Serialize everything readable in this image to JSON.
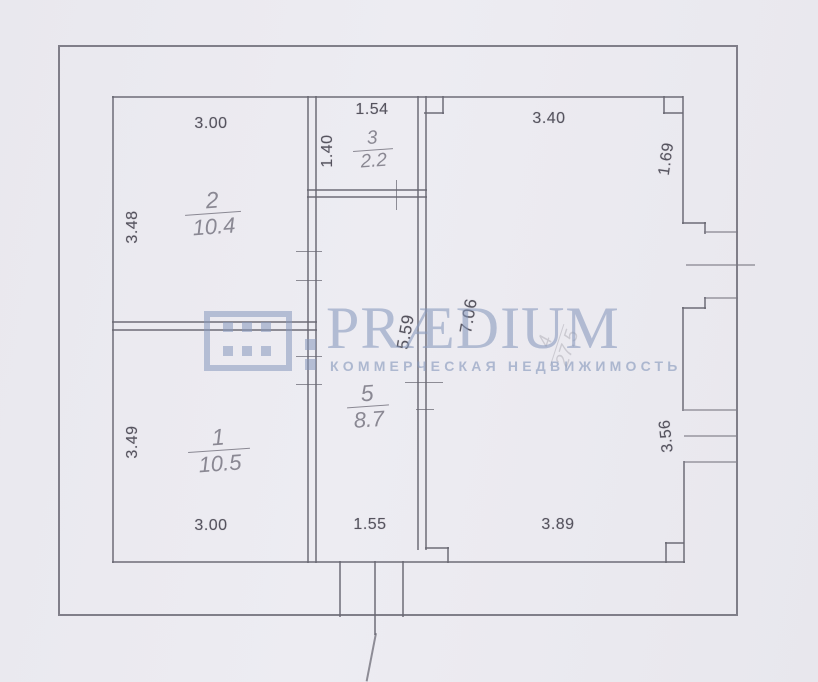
{
  "watermark": {
    "brand": "PRÆDIUM",
    "tagline": "КОММЕРЧЕСКАЯ НЕДВИЖИМОСТЬ",
    "color": "#8698bb"
  },
  "plan": {
    "rooms": [
      {
        "number": "1",
        "area": "10.5"
      },
      {
        "number": "2",
        "area": "10.4"
      },
      {
        "number": "3",
        "area": "2.2"
      },
      {
        "number": "4",
        "area": "27.5"
      },
      {
        "number": "5",
        "area": "8.7"
      }
    ],
    "dims": {
      "top_room2": "3.00",
      "top_room3": "1.54",
      "top_room4": "3.40",
      "left_room2": "3.48",
      "left_room1": "3.49",
      "room3_depth": "1.40",
      "right_upper": "1.69",
      "right_lower": "3.56",
      "bottom_room1": "3.00",
      "bottom_corridor": "1.55",
      "bottom_room4": "3.89",
      "corridor_length": "5.59",
      "room4_length": "7.06"
    }
  }
}
